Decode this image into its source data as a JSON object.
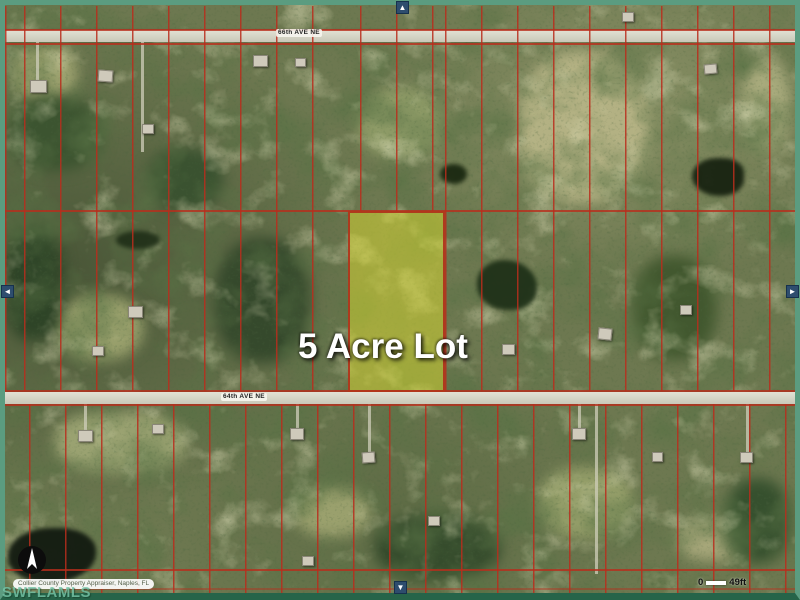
{
  "map": {
    "lot_label": "5 Acre Lot",
    "roads": [
      {
        "name": "66th AVE NE"
      },
      {
        "name": "64th AVE NE"
      }
    ],
    "highlighted_parcel": {
      "fill_color": "#ebe82d",
      "border_color": "#af2d19"
    },
    "parcel_line_color": "#b92d1c",
    "frame_color": "#5b9c80"
  },
  "controls": {
    "pan_up_icon": "▲",
    "pan_down_icon": "▼",
    "pan_left_icon": "◄",
    "pan_right_icon": "►"
  },
  "footer": {
    "attribution": "Collier County Property Appraiser, Naples, FL",
    "watermark": "SWFLAMLS",
    "scale_start": "0",
    "scale_end": "49ft"
  },
  "icons": {
    "compass": "north-arrow"
  }
}
